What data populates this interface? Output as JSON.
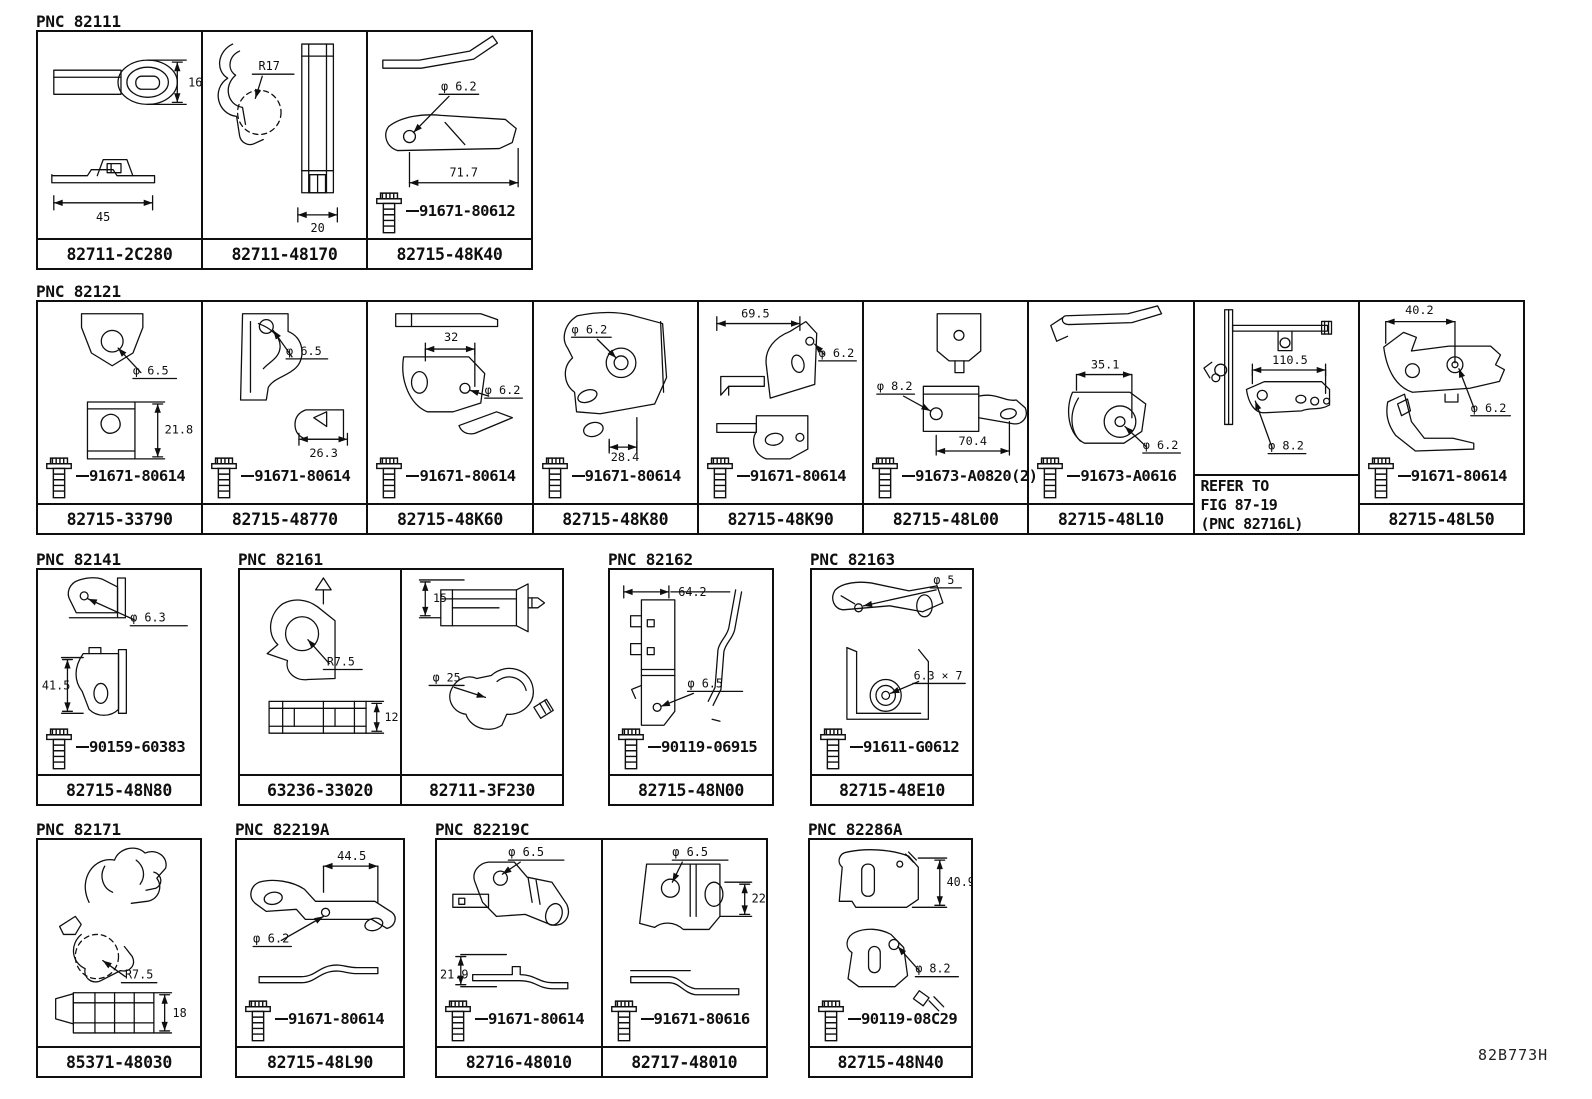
{
  "doc_code": "82B773H",
  "groups": [
    {
      "pnc": "PNC 82111",
      "cells": [
        {
          "part": "82711-2C280",
          "dims": [
            "16",
            "45"
          ]
        },
        {
          "part": "82711-48170",
          "dims": [
            "R17",
            "20"
          ]
        },
        {
          "part": "82715-48K40",
          "dims": [
            "φ 6.2",
            "71.7"
          ],
          "bolt": "91671-80612"
        }
      ]
    },
    {
      "pnc": "PNC 82121",
      "cells": [
        {
          "part": "82715-33790",
          "dims": [
            "φ 6.5",
            "21.8"
          ],
          "bolt": "91671-80614"
        },
        {
          "part": "82715-48770",
          "dims": [
            "φ 6.5",
            "26.3"
          ],
          "bolt": "91671-80614"
        },
        {
          "part": "82715-48K60",
          "dims": [
            "32",
            "φ 6.2"
          ],
          "bolt": "91671-80614"
        },
        {
          "part": "82715-48K80",
          "dims": [
            "φ 6.2",
            "28.4"
          ],
          "bolt": "91671-80614"
        },
        {
          "part": "82715-48K90",
          "dims": [
            "69.5",
            "φ 6.2"
          ],
          "bolt": "91671-80614"
        },
        {
          "part": "82715-48L00",
          "dims": [
            "φ 8.2",
            "70.4"
          ],
          "bolt": "91673-A0820(2)"
        },
        {
          "part": "82715-48L10",
          "dims": [
            "35.1",
            "φ 6.2"
          ],
          "bolt": "91673-A0616"
        },
        {
          "note": [
            "REFER TO",
            "FIG 87-19",
            "(PNC 82716L)"
          ],
          "dims": [
            "110.5",
            "φ 8.2"
          ]
        },
        {
          "part": "82715-48L50",
          "dims": [
            "40.2",
            "φ 6.2"
          ],
          "bolt": "91671-80614"
        }
      ]
    },
    {
      "pnc": "PNC 82141",
      "cells": [
        {
          "part": "82715-48N80",
          "dims": [
            "φ 6.3",
            "41.5"
          ],
          "bolt": "90159-60383"
        }
      ]
    },
    {
      "pnc": "PNC 82161",
      "cells": [
        {
          "part": "63236-33020",
          "dims": [
            "R7.5",
            "12"
          ]
        },
        {
          "part": "82711-3F230",
          "dims": [
            "15",
            "φ 25"
          ]
        }
      ]
    },
    {
      "pnc": "PNC 82162",
      "cells": [
        {
          "part": "82715-48N00",
          "dims": [
            "64.2",
            "φ 6.5"
          ],
          "bolt": "90119-06915"
        }
      ]
    },
    {
      "pnc": "PNC 82163",
      "cells": [
        {
          "part": "82715-48E10",
          "dims": [
            "φ 5",
            "6.3 × 7"
          ],
          "bolt": "91611-G0612"
        }
      ]
    },
    {
      "pnc": "PNC 82171",
      "cells": [
        {
          "part": "85371-48030",
          "dims": [
            "R7.5",
            "18"
          ]
        }
      ]
    },
    {
      "pnc": "PNC 82219A",
      "cells": [
        {
          "part": "82715-48L90",
          "dims": [
            "44.5",
            "φ 6.2"
          ],
          "bolt": "91671-80614"
        }
      ]
    },
    {
      "pnc": "PNC 82219C",
      "cells": [
        {
          "part": "82716-48010",
          "dims": [
            "φ 6.5",
            "21.9"
          ],
          "bolt": "91671-80614"
        },
        {
          "part": "82717-48010",
          "dims": [
            "φ 6.5",
            "22"
          ],
          "bolt": "91671-80616"
        }
      ]
    },
    {
      "pnc": "PNC 82286A",
      "cells": [
        {
          "part": "82715-48N40",
          "dims": [
            "40.9",
            "φ 8.2"
          ],
          "bolt": "90119-08C29"
        }
      ]
    }
  ]
}
